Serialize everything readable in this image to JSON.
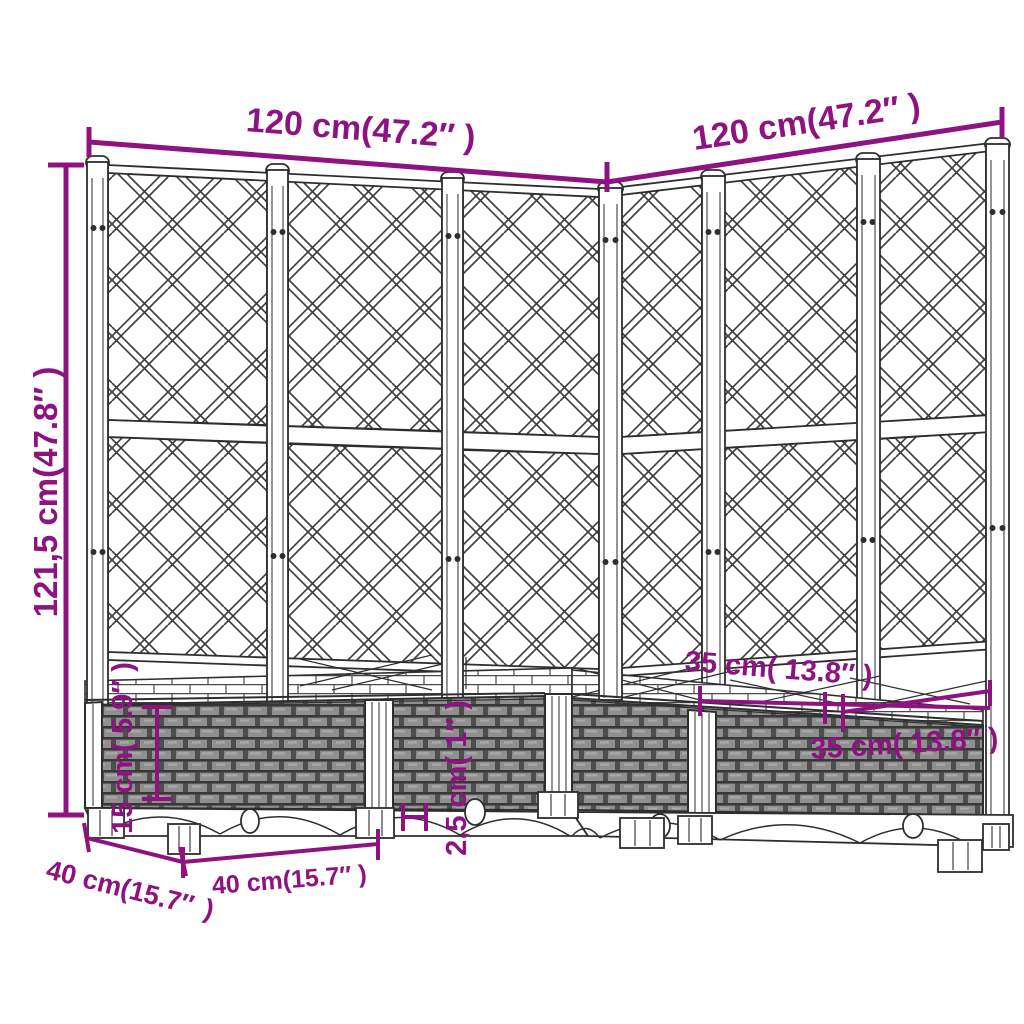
{
  "diagram": {
    "type": "product-dimension-drawing",
    "subject": "corner-garden-planter-with-trellis",
    "labels": {
      "top_width_left": "120 cm(47.2″ )",
      "top_width_right": "120 cm(47.2″ )",
      "total_height": "121,5 cm(47.8″ )",
      "inner_width_a": "35 cm( 13.8″ )",
      "inner_width_b": "35 cm( 13.8″ )",
      "box_height": "15 cm( 5.9″ )",
      "foot_height": "2,5 cm( 1″ )",
      "side_depth_line1": "40 cm(15.7″",
      "side_depth_line2": ")",
      "front_width": "40 cm(15.7″  )"
    },
    "colors": {
      "dimension_accent": "#8E1380",
      "outline": "#2E2E2E",
      "weave_fill": "#8F8F8F",
      "background": "#FFFFFF"
    }
  }
}
